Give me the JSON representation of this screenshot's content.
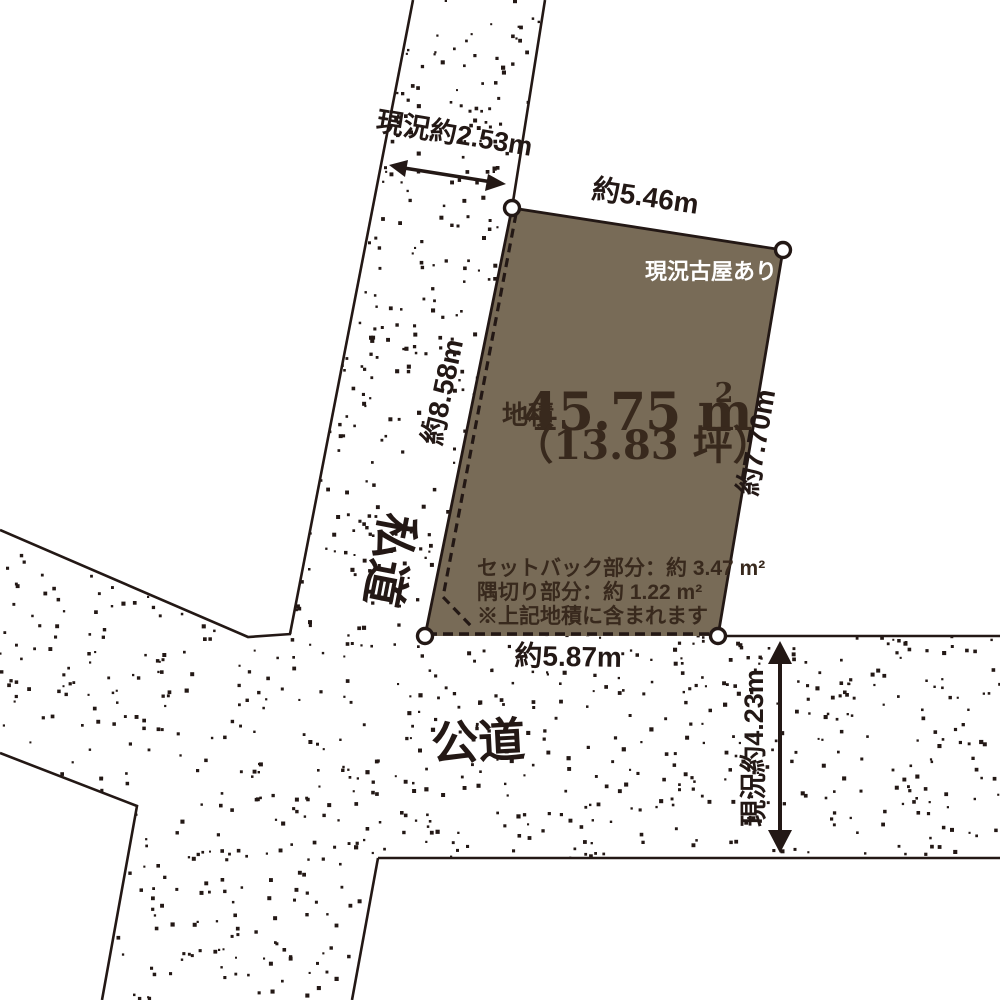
{
  "diagram": {
    "title_hint": "land-plot-survey-diagram",
    "parcel": {
      "area_label": "地積",
      "area_value": "45.75 m",
      "area_unit_sup": "2",
      "area_tsubo": "（13.83 坪）",
      "note_existing_house": "現況古屋あり",
      "setback_note": "セットバック部分：約 3.47 m²",
      "corner_cut_note": "隅切り部分：約 1.22 m²",
      "included_note": "※上記地積に含まれます",
      "fill_color": "#786B57",
      "text_color": "#38291D"
    },
    "dimensions": {
      "top_road_width": "現況約2.53m",
      "top_edge": "約5.46m",
      "left_edge": "約8.58m",
      "right_edge": "約7.70m",
      "bottom_edge": "約5.87m",
      "right_road_width": "現況約4.23m"
    },
    "roads": {
      "private_road": "私道",
      "public_road": "公道"
    },
    "colors": {
      "line": "#231815",
      "background": "#FFFFFF"
    }
  }
}
